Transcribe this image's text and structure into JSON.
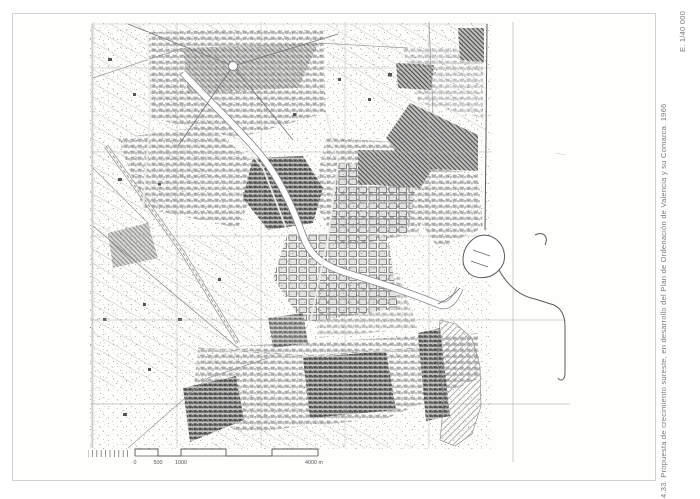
{
  "caption": {
    "text": "4.33. Propuesta de crecimiento sureste, en desarrollo del Plan de Ordenación de Valencia y su Comarca. 1966",
    "scale_note": "E. 1/40 000"
  },
  "scale_bar": {
    "labels": [
      "0",
      "500",
      "1000",
      "4000 m"
    ]
  },
  "colors": {
    "page_bg": "#ffffff",
    "frame": "#d2d2d0",
    "ink_dark": "#4e4e4e",
    "ink_mid": "#8a8a8a",
    "caption_text": "#7a7a7a"
  }
}
